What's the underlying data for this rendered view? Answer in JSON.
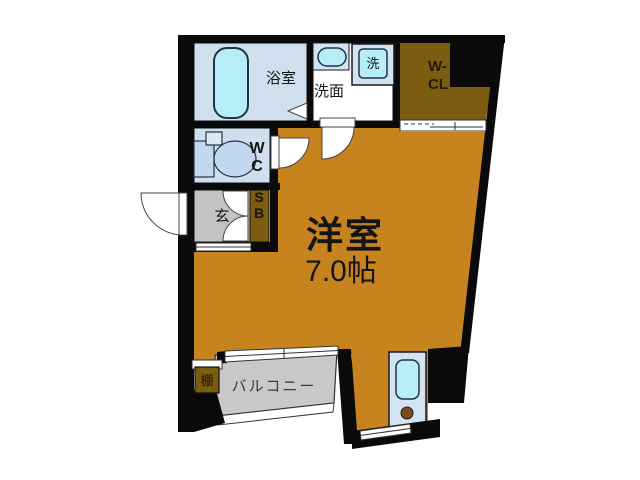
{
  "plan": {
    "bathroom_label": "浴室",
    "washroom_label": "洗面",
    "washer_label": "洗",
    "closet_label_1": "W-",
    "closet_label_2": "CL",
    "wc_label_1": "W",
    "wc_label_2": "C",
    "entrance_label": "玄",
    "shoebox_label_1": "S",
    "shoebox_label_2": "B",
    "main_room_label": "洋室",
    "main_room_size": "7.0帖",
    "shelf_label": "棚",
    "balcony_label": "バルコニー"
  },
  "colors": {
    "wall": "#0a0a0a",
    "main_room": "#c6831e",
    "closet": "#7b5c10",
    "water_fixture": "#b7edf7",
    "blue_room": "#cfdfee",
    "counter_blue": "#d3e3f2",
    "toilet_blue": "#c2d8ee",
    "genkan_gray": "#c3c3c3",
    "balcony_gray": "#c9c9c9",
    "shoebox_text": "#b5311c",
    "burner_brown": "#7c4a16"
  }
}
